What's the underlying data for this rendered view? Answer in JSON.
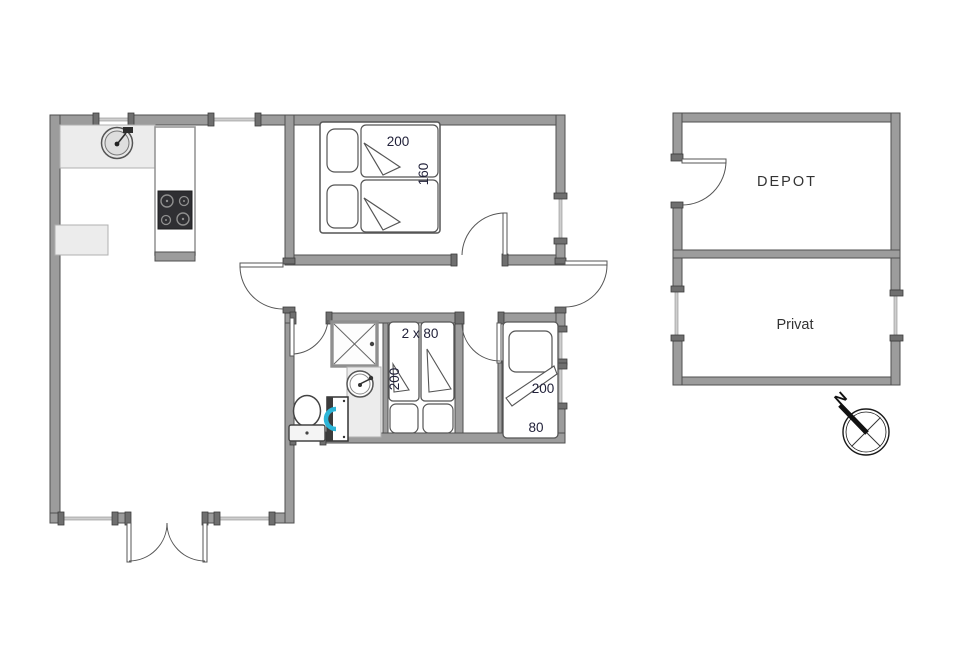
{
  "plan_title": "holiday-home-floor-plan",
  "rooms": {
    "bedroom_main": {
      "dim_length": "200",
      "dim_width": "160"
    },
    "bedroom_bunk": {
      "label": "2 x 80",
      "dim_length": "200"
    },
    "bedroom_single": {
      "dim_length": "200",
      "dim_width": "80"
    },
    "depot": {
      "label": "DEPOT"
    },
    "privat": {
      "label": "Privat"
    }
  },
  "compass": {
    "north_label": "N"
  },
  "colors": {
    "wall": "#9c9c9c",
    "wall_edge": "#4f4f4f",
    "line": "#555555",
    "dim_text": "#22223a",
    "room_text": "#333333",
    "washer_accent": "#2cb5d8",
    "counter": "#ececec",
    "stove": "#2f2f33"
  }
}
